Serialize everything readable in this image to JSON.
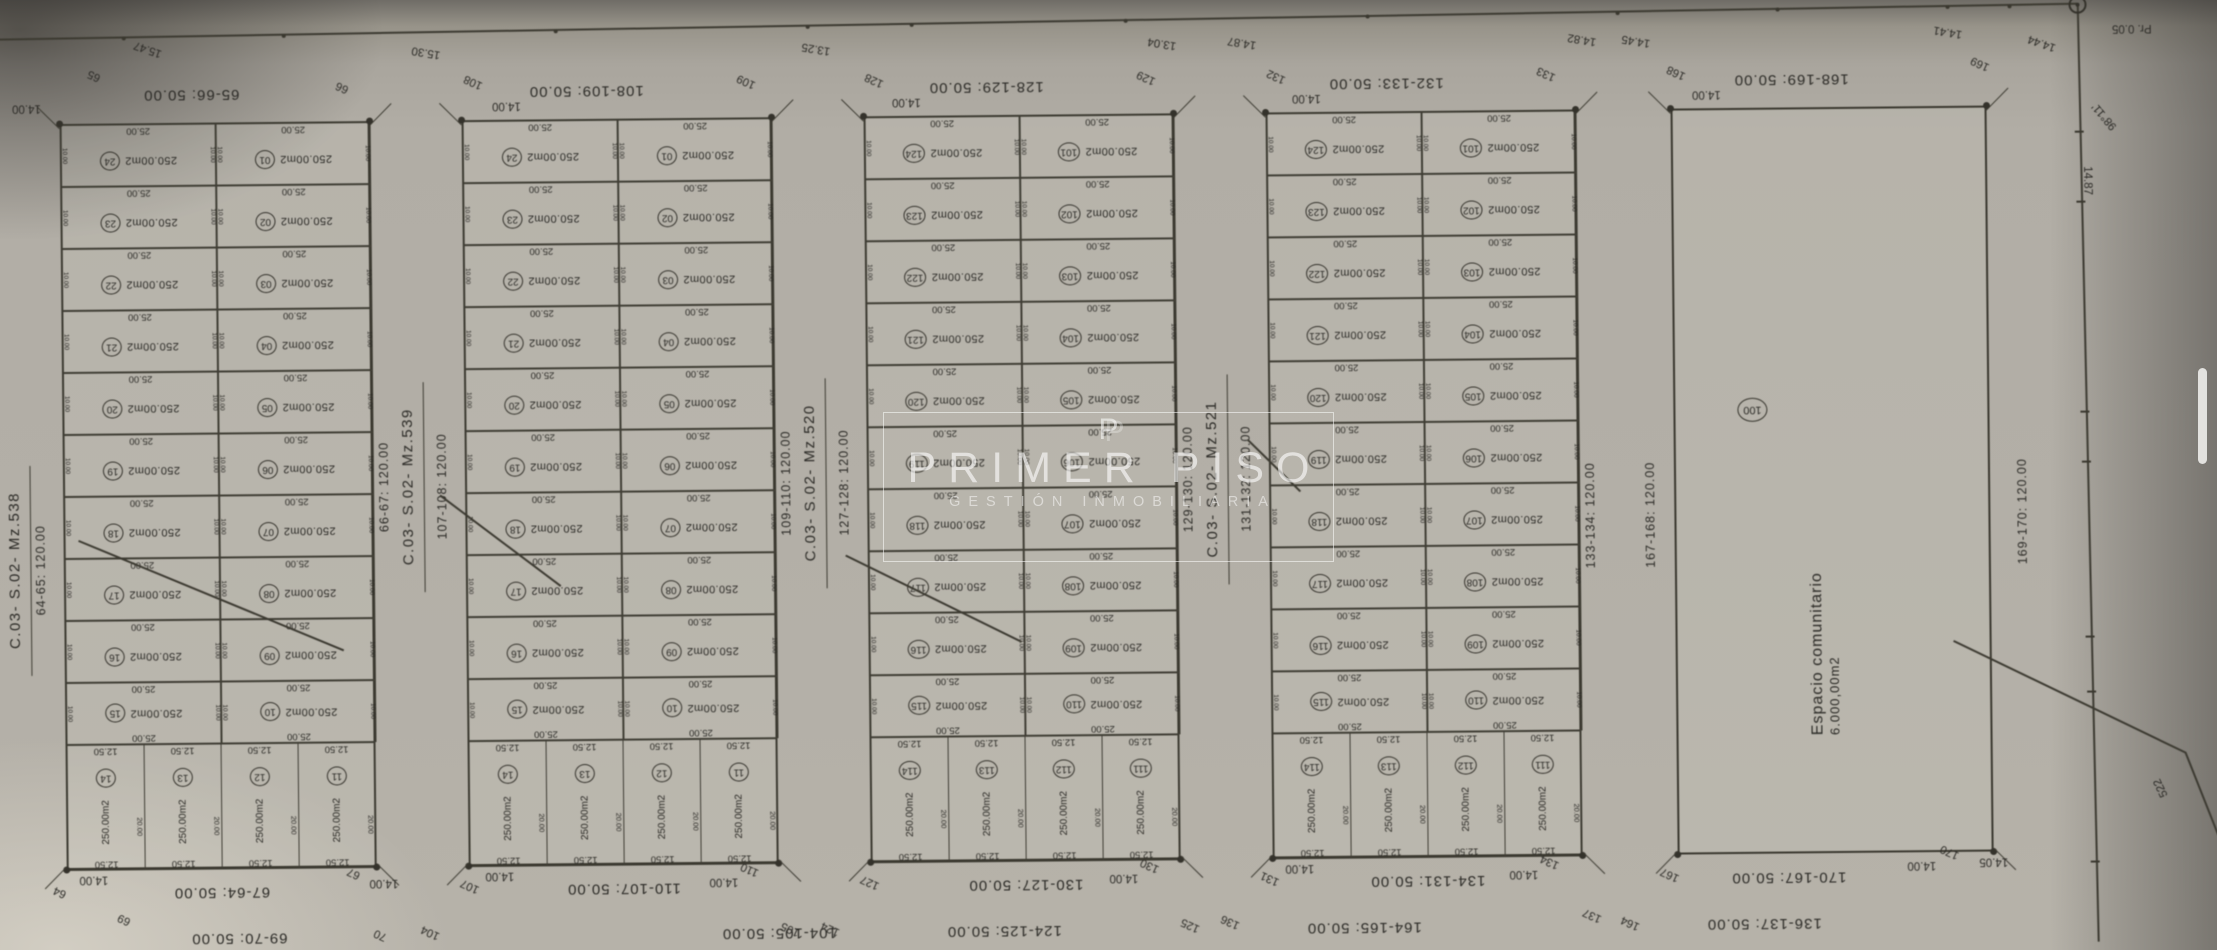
{
  "watermark": {
    "logo": "P",
    "title": "PRIMER PISO",
    "subtitle": "GESTIÓN INMOBILIARIA"
  },
  "frame": {
    "corner_point_label": "Pr. 0.05",
    "bearing_label": "98°11'",
    "side_distance_label": "14.87",
    "road_label": "522"
  },
  "lot_defaults": {
    "area_label": "250.00m2",
    "width_label": "25.00",
    "depth_label": "10.00",
    "bottom_width_label": "12.50",
    "bottom_depth_label": "20.00"
  },
  "blocks": [
    {
      "type": "lots",
      "mz_label": "C.03- S.02- Mz.538",
      "top": "65-66: 50.00",
      "bottom": "67-64: 50.00",
      "left": "64-65: 120.00",
      "right": "66-67: 120.00",
      "left_column": [
        "24",
        "23",
        "22",
        "21",
        "20",
        "19",
        "18",
        "17",
        "16",
        "15"
      ],
      "right_column": [
        "01",
        "02",
        "03",
        "04",
        "05",
        "06",
        "07",
        "08",
        "09",
        "10"
      ],
      "bottom_row": [
        "14",
        "13",
        "12",
        "11"
      ]
    },
    {
      "type": "lots",
      "mz_label": "C.03- S.02- Mz.539",
      "top": "108-109: 50.00",
      "bottom": "110-107: 50.00",
      "left": "107-108: 120.00",
      "right": "109-110: 120.00",
      "left_column": [
        "24",
        "23",
        "22",
        "21",
        "20",
        "19",
        "18",
        "17",
        "16",
        "15"
      ],
      "right_column": [
        "01",
        "02",
        "03",
        "04",
        "05",
        "06",
        "07",
        "08",
        "09",
        "10"
      ],
      "bottom_row": [
        "14",
        "13",
        "12",
        "11"
      ]
    },
    {
      "type": "lots",
      "mz_label": "C.03- S.02- Mz.520",
      "top": "128-129: 50.00",
      "bottom": "130-127: 50.00",
      "left": "127-128: 120.00",
      "right": "129-130: 120.00",
      "left_column": [
        "124",
        "123",
        "122",
        "121",
        "120",
        "119",
        "118",
        "117",
        "116",
        "115"
      ],
      "right_column": [
        "101",
        "102",
        "103",
        "104",
        "105",
        "106",
        "107",
        "108",
        "109",
        "110"
      ],
      "bottom_row": [
        "114",
        "113",
        "112",
        "111"
      ]
    },
    {
      "type": "lots",
      "mz_label": "C.03- S.02- Mz.521",
      "top": "132-133: 50.00",
      "bottom": "134-131: 50.00",
      "left": "131-132: 120.00",
      "right": "133-134: 120.00",
      "left_column": [
        "124",
        "123",
        "122",
        "121",
        "120",
        "119",
        "118",
        "117",
        "116",
        "115"
      ],
      "right_column": [
        "101",
        "102",
        "103",
        "104",
        "105",
        "106",
        "107",
        "108",
        "109",
        "110"
      ],
      "bottom_row": [
        "114",
        "113",
        "112",
        "111"
      ]
    },
    {
      "type": "open",
      "mz_label": null,
      "top": "168-169: 50.00",
      "bottom": "170-167: 50.00",
      "left": "167-168: 120.00",
      "right": "169-170: 120.00",
      "lot_number": "100",
      "name": "Espacio comunitario",
      "area": "6.000,00m2"
    }
  ],
  "outer_bottom_labels": [
    "69-70: 50.00",
    "104-105: 50.00",
    "124-125: 50.00",
    "164-165: 50.00",
    "136-137: 50.00"
  ],
  "top_margin_labels": [
    "15.47",
    "65",
    "66",
    "15.30",
    "108",
    "14.00",
    "109",
    "13.25",
    "128",
    "14.00",
    "129",
    "13.04",
    "132",
    "14.00",
    "14.87",
    "133",
    "14.82",
    "168",
    "14.45",
    "14.00",
    "169",
    "14.41",
    "14.44",
    "98°11'",
    "14.87",
    "Pr. 0.05",
    "14.00"
  ],
  "bottom_margin_labels": [
    "64",
    "14.00",
    "67",
    "14.00",
    "69",
    "70",
    "104",
    "107",
    "14.00",
    "110",
    "14.00",
    "105",
    "124",
    "127",
    "130",
    "14.00",
    "125",
    "136",
    "131",
    "14.00",
    "134",
    "14.00",
    "137",
    "164",
    "167",
    "170",
    "14.05",
    "14.00",
    "522"
  ]
}
